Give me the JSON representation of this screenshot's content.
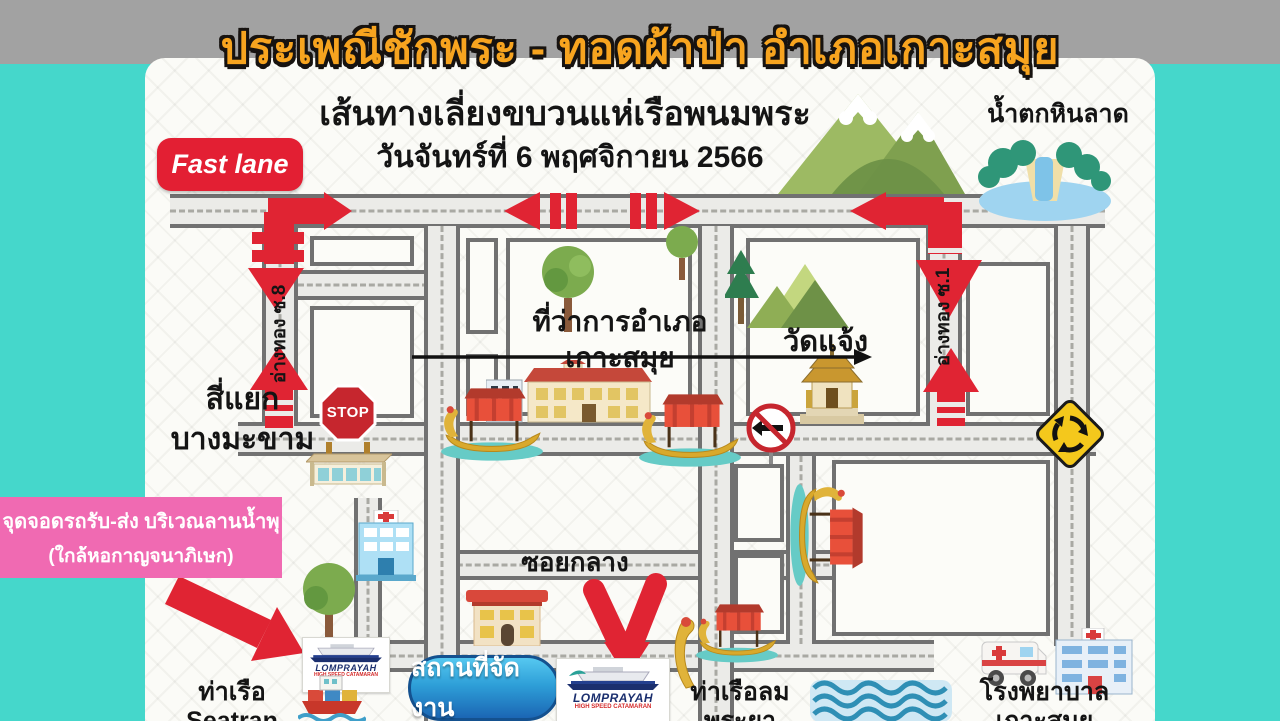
{
  "header": {
    "title": "ประเพณีชักพระ - ทอดผ้าป่า อำเภอเกาะสมุย",
    "subtitle": "เส้นทางเลี่ยงขบวนแห่เรือพนมพระ",
    "date": "วันจันทร์ที่ 6 พฤศจิกายน 2566",
    "fast_lane": "Fast lane"
  },
  "map": {
    "waterfall": "น้ำตกหินลาด",
    "district_office_line1": "ที่ว่าการอำเภอ",
    "district_office_line2": "เกาะสมุย",
    "temple": "วัดแจ้ง",
    "intersection_line1": "สี่แยก",
    "intersection_line2": "บางมะขาม",
    "soi8": "อ่างทอง ซ.8",
    "soi1": "อ่างทอง ซ.1",
    "soi_klang": "ซอยกลาง",
    "stop_sign": "STOP",
    "pier_seatran": "ท่าเรือ Seatran",
    "pier_lomprayah": "ท่าเรือลมพระยา",
    "hospital": "โรงพยาบาลเกาะสมุย"
  },
  "callouts": {
    "parking_line1": "จุดจอดรถรับ-ส่ง บริเวณลานน้ำพุ",
    "parking_line2": "(ใกล้หอกาญจนาภิเษก)",
    "venue": "สถานที่จัดงาน"
  },
  "brand": {
    "name": "LOMPRAYAH",
    "tagline": "HIGH SPEED CATAMARAN"
  },
  "colors": {
    "teal_background": "#45d7cb",
    "band_gray": "#a2a2a2",
    "title_orange": "#f7a41f",
    "route_red": "#e02433",
    "parking_pink": "#f06ab2",
    "venue_blue": "#1b66b4",
    "road_fill": "#ebebe8",
    "road_border": "#717171",
    "sign_yellow": "#f4c81c"
  }
}
